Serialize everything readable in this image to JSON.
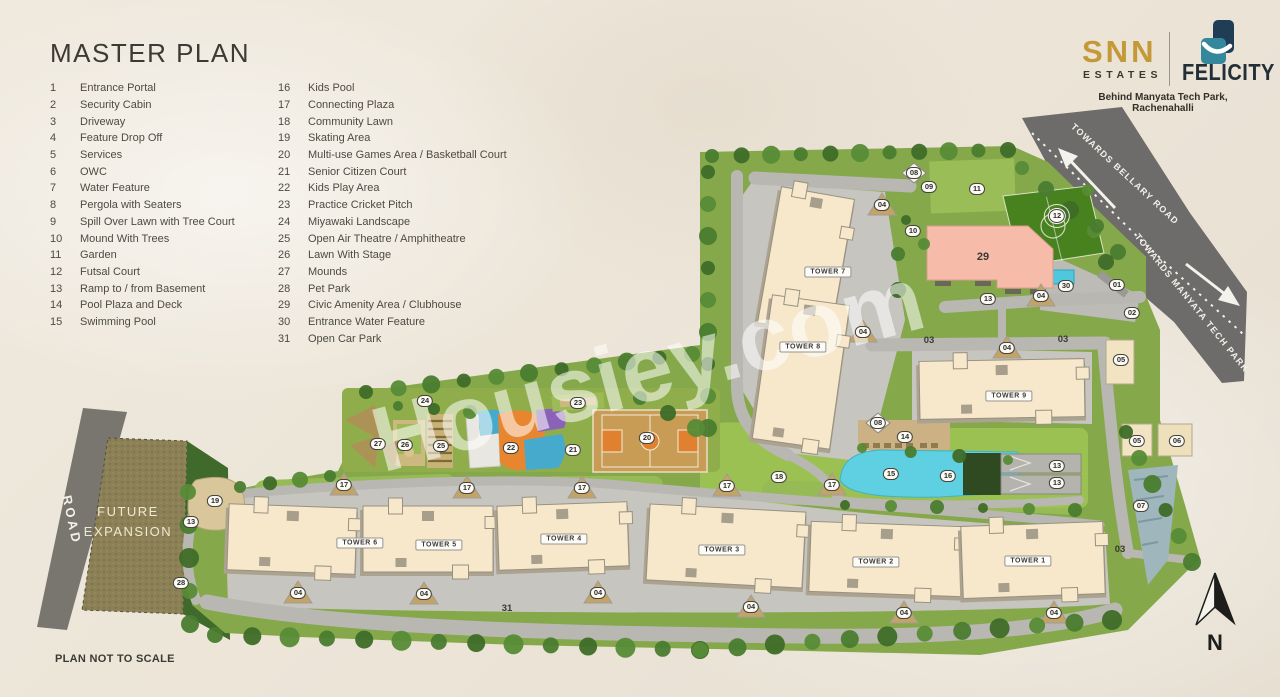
{
  "title": "MASTER PLAN",
  "footer_note": "PLAN NOT TO SCALE",
  "watermark": "Housiey.com",
  "brand": {
    "snn": "SNN",
    "estates": "ESTATES",
    "project": "FELICITY",
    "tagline": "Behind Manyata Tech Park, Rachenahalli",
    "colors": {
      "gold": "#C49A38",
      "teal": "#35879C",
      "navy": "#1F3D54"
    }
  },
  "legend": {
    "col1": [
      {
        "num": "1",
        "label": "Entrance Portal"
      },
      {
        "num": "2",
        "label": "Security Cabin"
      },
      {
        "num": "3",
        "label": "Driveway"
      },
      {
        "num": "4",
        "label": "Feature Drop Off"
      },
      {
        "num": "5",
        "label": "Services"
      },
      {
        "num": "6",
        "label": "OWC"
      },
      {
        "num": "7",
        "label": "Water Feature"
      },
      {
        "num": "8",
        "label": "Pergola with Seaters"
      },
      {
        "num": "9",
        "label": "Spill Over Lawn with Tree Court"
      },
      {
        "num": "10",
        "label": "Mound With Trees"
      },
      {
        "num": "11",
        "label": "Garden"
      },
      {
        "num": "12",
        "label": "Futsal Court"
      },
      {
        "num": "13",
        "label": "Ramp to / from Basement"
      },
      {
        "num": "14",
        "label": "Pool Plaza and Deck"
      },
      {
        "num": "15",
        "label": "Swimming Pool"
      }
    ],
    "col2": [
      {
        "num": "16",
        "label": "Kids Pool"
      },
      {
        "num": "17",
        "label": "Connecting Plaza"
      },
      {
        "num": "18",
        "label": "Community Lawn"
      },
      {
        "num": "19",
        "label": "Skating Area"
      },
      {
        "num": "20",
        "label": "Multi-use Games Area / Basketball Court"
      },
      {
        "num": "21",
        "label": "Senior Citizen Court"
      },
      {
        "num": "22",
        "label": "Kids Play Area"
      },
      {
        "num": "23",
        "label": "Practice Cricket Pitch"
      },
      {
        "num": "24",
        "label": "Miyawaki Landscape"
      },
      {
        "num": "25",
        "label": "Open Air Theatre / Amphitheatre"
      },
      {
        "num": "26",
        "label": "Lawn With Stage"
      },
      {
        "num": "27",
        "label": "Mounds"
      },
      {
        "num": "28",
        "label": "Pet Park"
      },
      {
        "num": "29",
        "label": "Civic Amenity Area / Clubhouse"
      },
      {
        "num": "30",
        "label": "Entrance Water Feature"
      },
      {
        "num": "31",
        "label": "Open Car Park"
      }
    ]
  },
  "plan": {
    "road_labels": [
      "TOWARDS BELLARY ROAD",
      "TOWARDS MANYATA TECH PARK"
    ],
    "future_expansion": "FUTURE EXPANSION",
    "road": "ROAD",
    "north": "N",
    "towers": [
      {
        "label": "TOWER 7",
        "x": 828,
        "y": 272
      },
      {
        "label": "TOWER 8",
        "x": 803,
        "y": 347
      },
      {
        "label": "TOWER 9",
        "x": 1009,
        "y": 396
      },
      {
        "label": "TOWER 6",
        "x": 360,
        "y": 543
      },
      {
        "label": "TOWER 5",
        "x": 439,
        "y": 545
      },
      {
        "label": "TOWER 4",
        "x": 564,
        "y": 539
      },
      {
        "label": "TOWER 3",
        "x": 722,
        "y": 550
      },
      {
        "label": "TOWER 2",
        "x": 876,
        "y": 562
      },
      {
        "label": "TOWER 1",
        "x": 1028,
        "y": 561
      }
    ],
    "markers": [
      {
        "n": "08",
        "x": 914,
        "y": 173
      },
      {
        "n": "09",
        "x": 929,
        "y": 187
      },
      {
        "n": "11",
        "x": 977,
        "y": 189
      },
      {
        "n": "04",
        "x": 882,
        "y": 205
      },
      {
        "n": "12",
        "x": 1057,
        "y": 216,
        "style": "circled"
      },
      {
        "n": "10",
        "x": 913,
        "y": 231
      },
      {
        "n": "29",
        "x": 983,
        "y": 257,
        "style": "plain big"
      },
      {
        "n": "30",
        "x": 1066,
        "y": 286
      },
      {
        "n": "01",
        "x": 1117,
        "y": 285
      },
      {
        "n": "13",
        "x": 988,
        "y": 299
      },
      {
        "n": "04",
        "x": 1041,
        "y": 296
      },
      {
        "n": "02",
        "x": 1132,
        "y": 313
      },
      {
        "n": "04",
        "x": 863,
        "y": 332
      },
      {
        "n": "03",
        "x": 929,
        "y": 341,
        "style": "plain"
      },
      {
        "n": "03",
        "x": 1063,
        "y": 340,
        "style": "plain"
      },
      {
        "n": "04",
        "x": 1007,
        "y": 348
      },
      {
        "n": "05",
        "x": 1121,
        "y": 360
      },
      {
        "n": "24",
        "x": 425,
        "y": 401
      },
      {
        "n": "23",
        "x": 578,
        "y": 403
      },
      {
        "n": "08",
        "x": 878,
        "y": 423
      },
      {
        "n": "14",
        "x": 905,
        "y": 437
      },
      {
        "n": "20",
        "x": 647,
        "y": 438
      },
      {
        "n": "05",
        "x": 1137,
        "y": 441
      },
      {
        "n": "06",
        "x": 1177,
        "y": 441
      },
      {
        "n": "27",
        "x": 378,
        "y": 444
      },
      {
        "n": "26",
        "x": 405,
        "y": 445
      },
      {
        "n": "25",
        "x": 441,
        "y": 446
      },
      {
        "n": "22",
        "x": 511,
        "y": 448
      },
      {
        "n": "21",
        "x": 573,
        "y": 450
      },
      {
        "n": "13",
        "x": 1057,
        "y": 466
      },
      {
        "n": "15",
        "x": 891,
        "y": 474
      },
      {
        "n": "16",
        "x": 948,
        "y": 476
      },
      {
        "n": "18",
        "x": 779,
        "y": 477
      },
      {
        "n": "13",
        "x": 1057,
        "y": 483
      },
      {
        "n": "17",
        "x": 344,
        "y": 485
      },
      {
        "n": "17",
        "x": 467,
        "y": 488
      },
      {
        "n": "17",
        "x": 582,
        "y": 488
      },
      {
        "n": "17",
        "x": 727,
        "y": 486
      },
      {
        "n": "17",
        "x": 832,
        "y": 485
      },
      {
        "n": "19",
        "x": 215,
        "y": 501
      },
      {
        "n": "07",
        "x": 1141,
        "y": 506
      },
      {
        "n": "13",
        "x": 191,
        "y": 522
      },
      {
        "n": "03",
        "x": 1120,
        "y": 550,
        "style": "plain"
      },
      {
        "n": "28",
        "x": 181,
        "y": 583
      },
      {
        "n": "04",
        "x": 298,
        "y": 593
      },
      {
        "n": "04",
        "x": 424,
        "y": 594
      },
      {
        "n": "04",
        "x": 598,
        "y": 593
      },
      {
        "n": "04",
        "x": 751,
        "y": 607
      },
      {
        "n": "31",
        "x": 507,
        "y": 609,
        "style": "plain"
      },
      {
        "n": "04",
        "x": 904,
        "y": 613
      },
      {
        "n": "04",
        "x": 1054,
        "y": 613
      }
    ]
  },
  "colors": {
    "background": "#ECE6DA",
    "highway": "#6D6C6A",
    "internal_road": "#B9B7B2",
    "site_green": "#85A84B",
    "tree_green": "#4A7C2F",
    "building_cream": "#F7E8CB",
    "clubhouse_pink": "#F6BBA9",
    "pool_cyan": "#5FD0E2",
    "court_tan": "#C89C55",
    "court_orange": "#E0812F",
    "futsal_green": "#47821F",
    "future_expansion": "#8C8156"
  }
}
